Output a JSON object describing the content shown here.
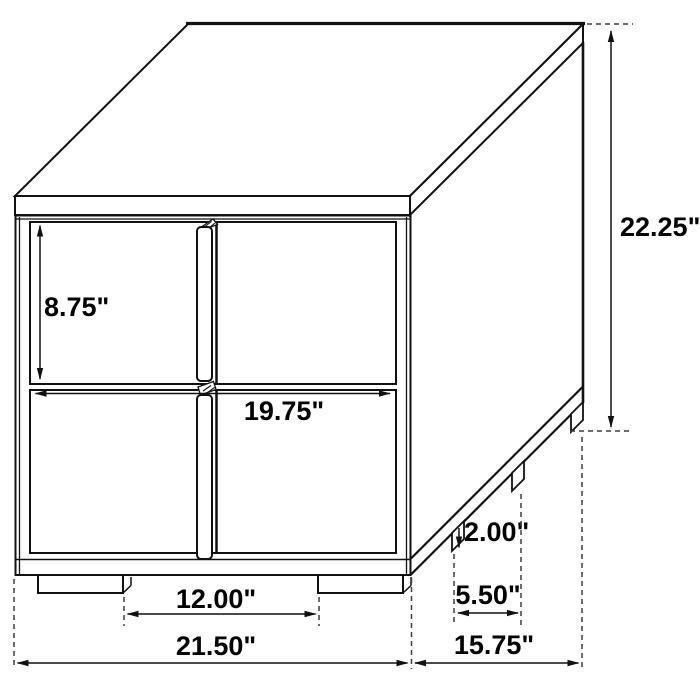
{
  "diagram": {
    "type": "furniture-dimension-drawing",
    "subject": "two-drawer nightstand line drawing",
    "unit": "inches",
    "background": "#ffffff",
    "line_color": "#111111",
    "dashed_color": "#3f3f3f",
    "labels": {
      "drawer_height": "8.75\"",
      "drawer_width": "19.75\"",
      "overall_height": "22.25\"",
      "leg_height": "2.00\"",
      "side_leg_spacing": "5.50\"",
      "front_leg_spacing": "12.00\"",
      "overall_width": "21.50\"",
      "overall_depth": "15.75\""
    }
  }
}
